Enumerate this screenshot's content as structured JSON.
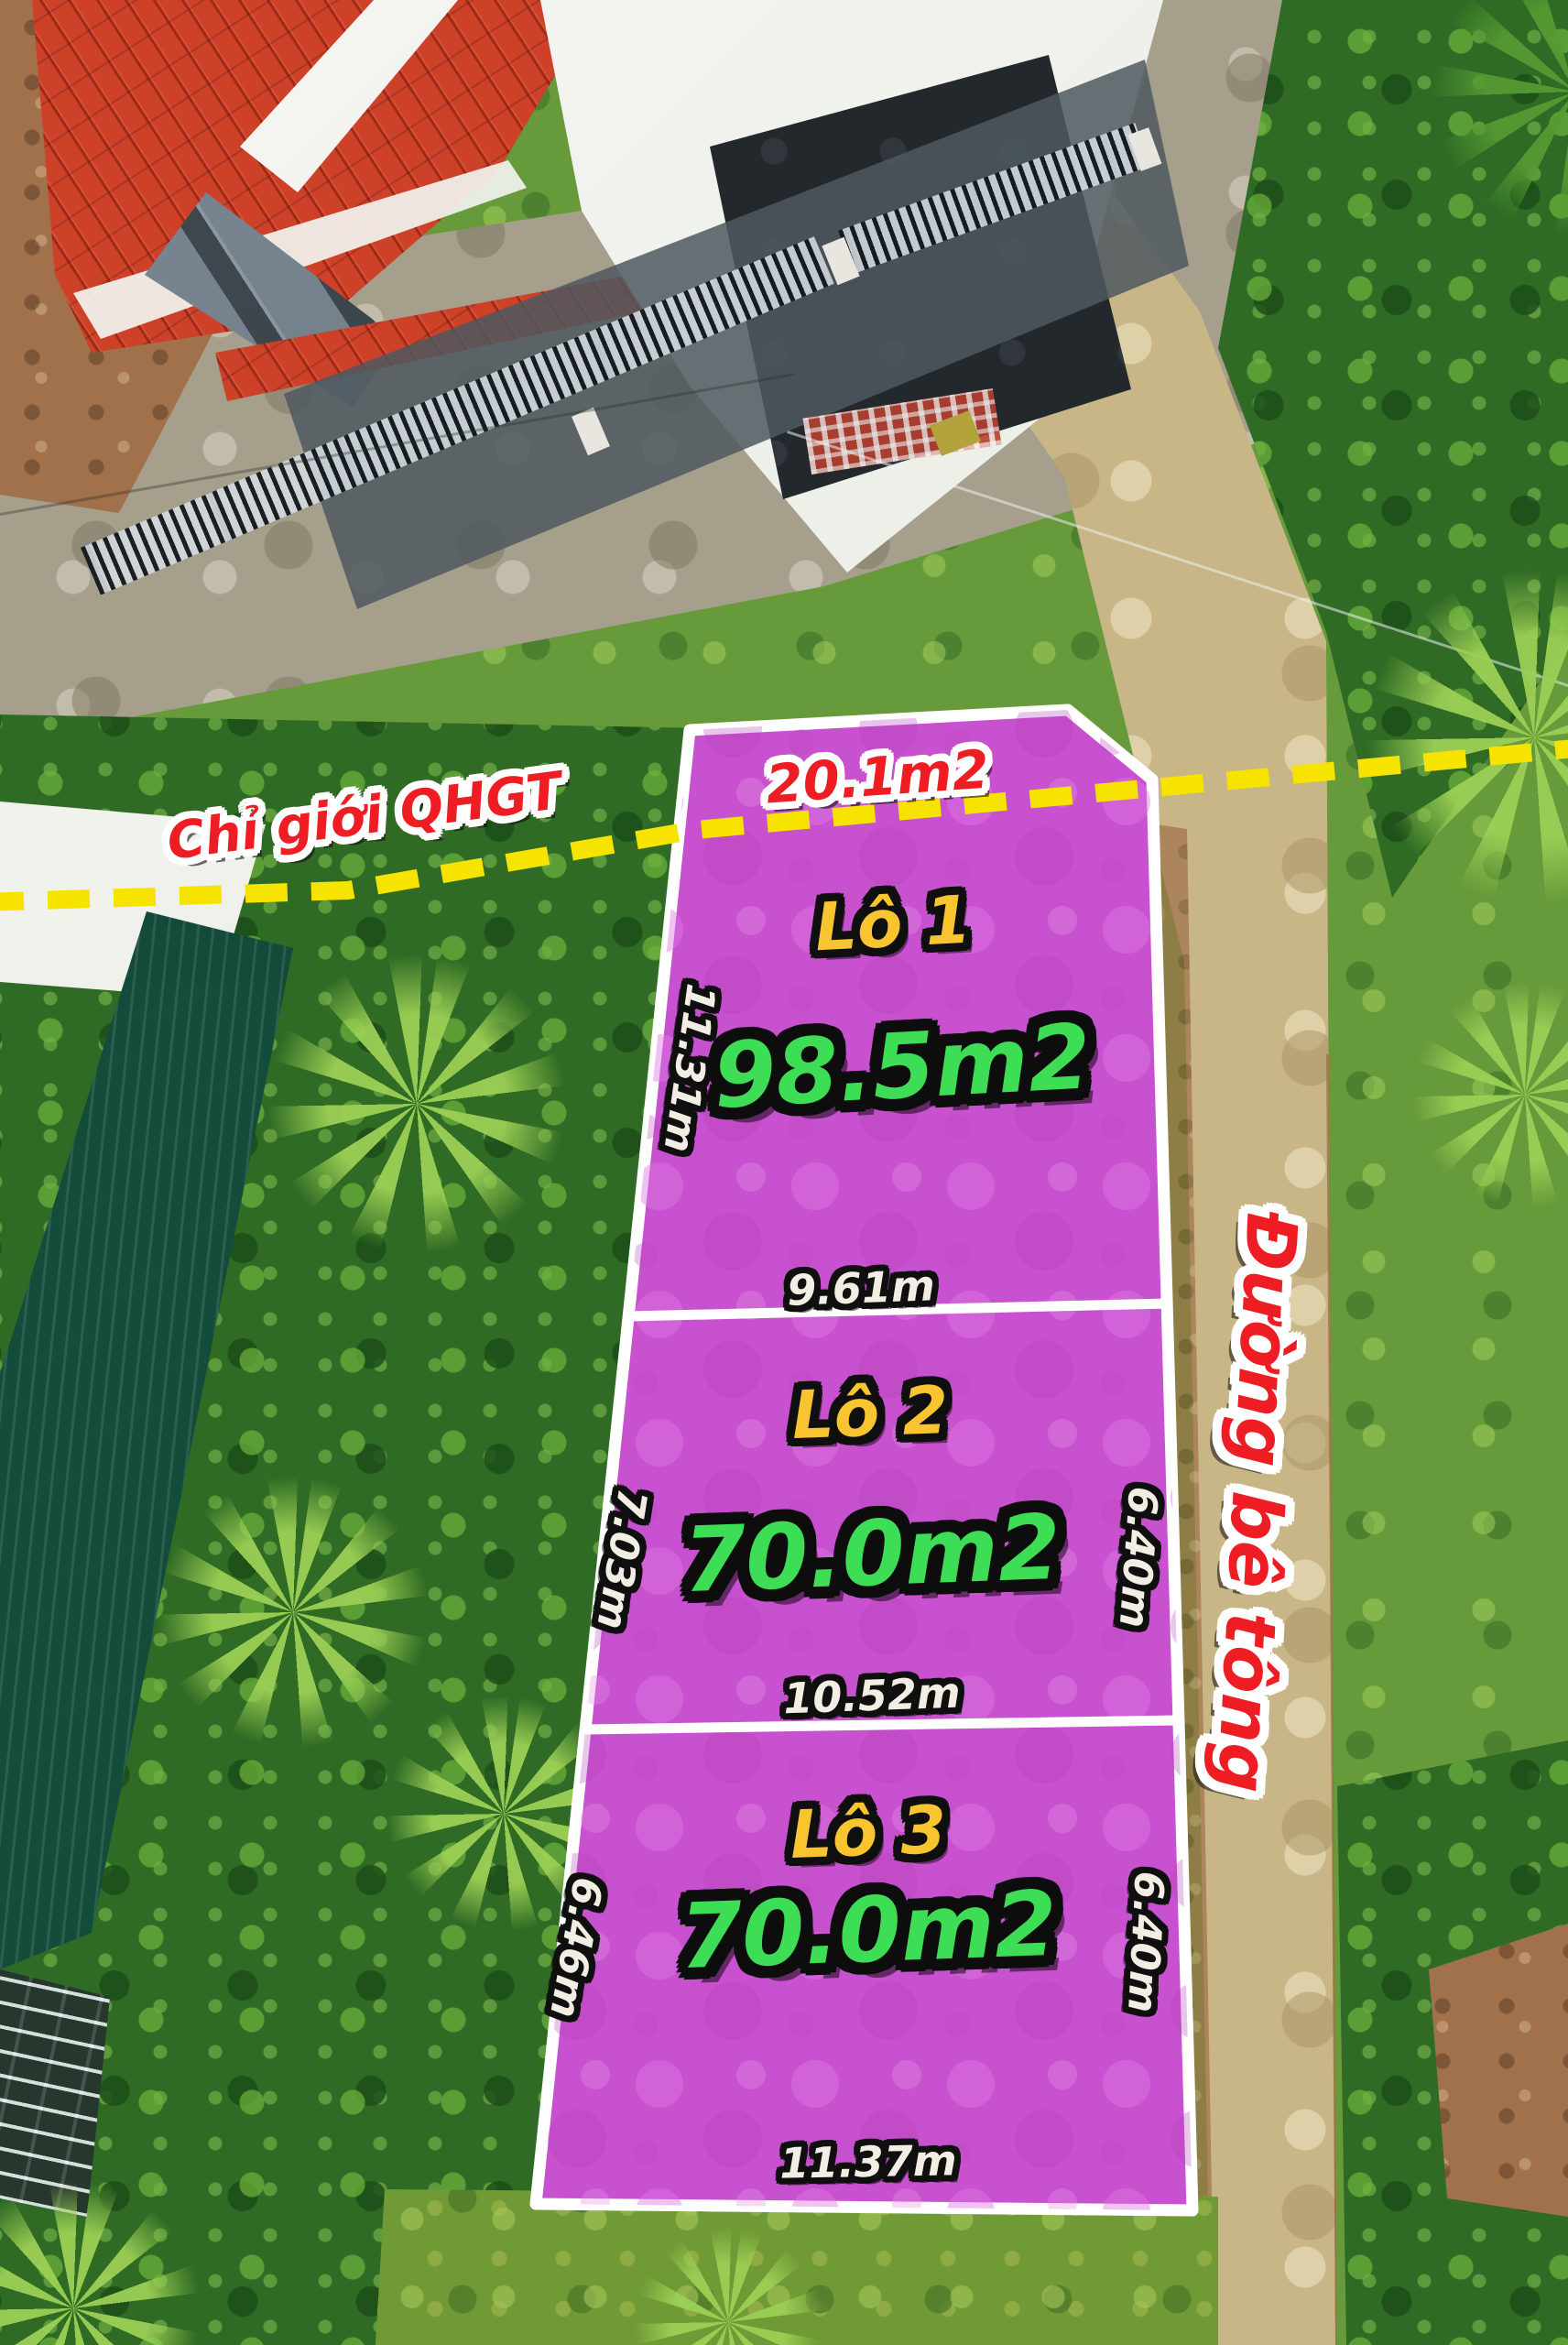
{
  "annotations": {
    "planning_boundary_label": "Chỉ giới QHGT",
    "road_label": "Đường bê tông",
    "clipped_area_label": "20.1m2"
  },
  "plots": [
    {
      "name": "Lô 1",
      "area_label": "98.5m2",
      "side_left": "11.31m",
      "side_bottom": "9.61m"
    },
    {
      "name": "Lô 2",
      "area_label": "70.0m2",
      "side_left": "7.03m",
      "side_right": "6.40m",
      "side_bottom": "10.52m"
    },
    {
      "name": "Lô 3",
      "area_label": "70.0m2",
      "side_left": "6.46m",
      "side_right": "6.40m",
      "side_bottom": "11.37m"
    }
  ],
  "colors": {
    "plot_fill": "#c851cf",
    "plot_border": "#ffffff",
    "dashed_boundary": "#f6e400",
    "label_red": "#ee1d23",
    "label_yellow": "#f8c531",
    "label_green": "#3ddd55",
    "label_cream": "#f3eee3"
  }
}
